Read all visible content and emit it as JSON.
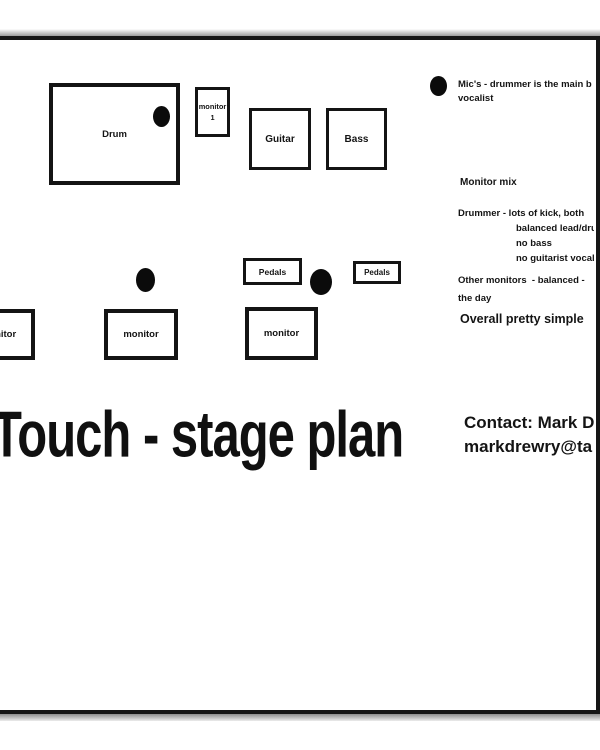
{
  "colors": {
    "ink": "#141414",
    "paper": "#ffffff",
    "mic_dot": "#0b0b0b"
  },
  "stage": {
    "drum": {
      "label": "Drum"
    },
    "monitor1": {
      "line1": "monitor",
      "line2": "1"
    },
    "guitar": {
      "label": "Guitar"
    },
    "bass": {
      "label": "Bass"
    },
    "pedals_left": {
      "label": "Pedals"
    },
    "pedals_right": {
      "label": "Pedals"
    },
    "monitor_left": {
      "label": "monitor"
    },
    "monitor_mid": {
      "label": "monitor"
    },
    "monitor_right": {
      "label": "monitor"
    }
  },
  "legend": {
    "line1": "Mic's - drummer is the main b",
    "line2": "vocalist"
  },
  "monitor_mix": {
    "heading": "Monitor mix",
    "drummer": "Drummer - lots of kick, both",
    "drummer_details": [
      "balanced lead/dru",
      "no bass",
      "no guitarist vocal"
    ],
    "others_line1": "Other monitors  - balanced -",
    "others_line2": "the day",
    "summary": "Overall pretty simple"
  },
  "title": "Touch - stage plan",
  "contact": {
    "line1": "Contact: Mark D",
    "line2": "markdrewry@ta"
  }
}
